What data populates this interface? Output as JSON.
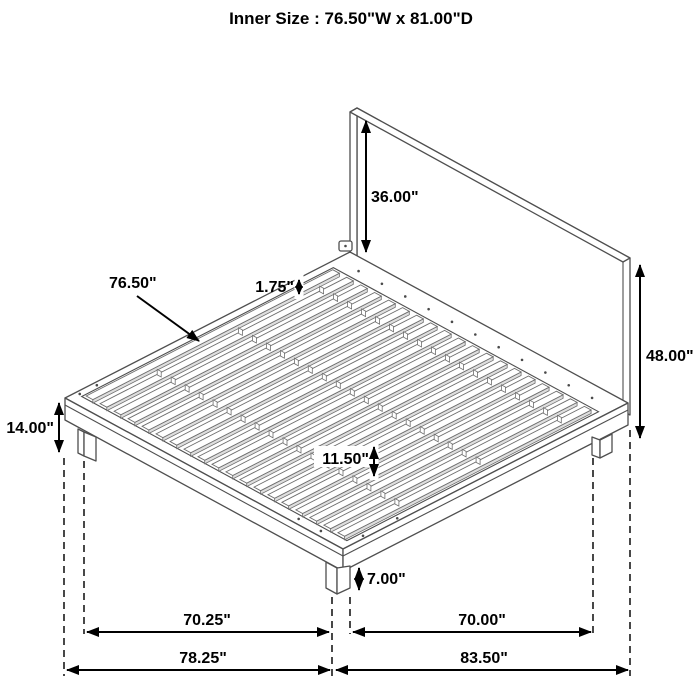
{
  "title": "Inner Size : 76.50\"W x 81.00\"D",
  "dimensions": {
    "headboard_panel_height": "36.00\"",
    "headboard_total_height": "48.00\"",
    "platform_height": "14.00\"",
    "slat_gap": "11.50\"",
    "leg_height": "7.00\"",
    "slat_width": "1.75\"",
    "slat_length": "76.50\"",
    "left_leg_span": "70.25\"",
    "outer_width": "78.25\"",
    "right_leg_span": "70.00\"",
    "outer_depth": "83.50\""
  },
  "colors": {
    "line_art": "#4f4f4f",
    "dimension": "#000000",
    "background": "#ffffff"
  }
}
